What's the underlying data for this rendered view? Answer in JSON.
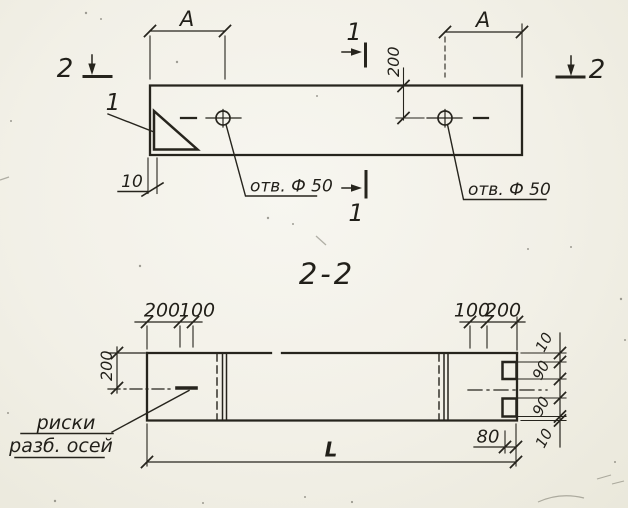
{
  "plan_view": {
    "dim_a_left": "A",
    "dim_a_right": "A",
    "dim_200": "200",
    "dim_10": "10",
    "detail_mark": "1",
    "section_mark_1_top": "1",
    "section_mark_1_bottom": "1",
    "section_mark_2_left": "2",
    "section_mark_2_right": "2",
    "hole_left_label": "отв. Ф 50",
    "hole_right_label": "отв. Ф 50"
  },
  "section_view": {
    "title": "2-2",
    "top_dims_left": [
      "200",
      "100"
    ],
    "top_dims_right": [
      "100",
      "200"
    ],
    "side_dim": "200",
    "right_stack_dims": [
      "10",
      "90",
      "90",
      "10"
    ],
    "dim_80": "80",
    "dim_length": "L",
    "axis_note_line1": "риски",
    "axis_note_line2": "разб. осей"
  },
  "colors": {
    "ink": "#26241d",
    "paper": "#f2f0e7"
  }
}
